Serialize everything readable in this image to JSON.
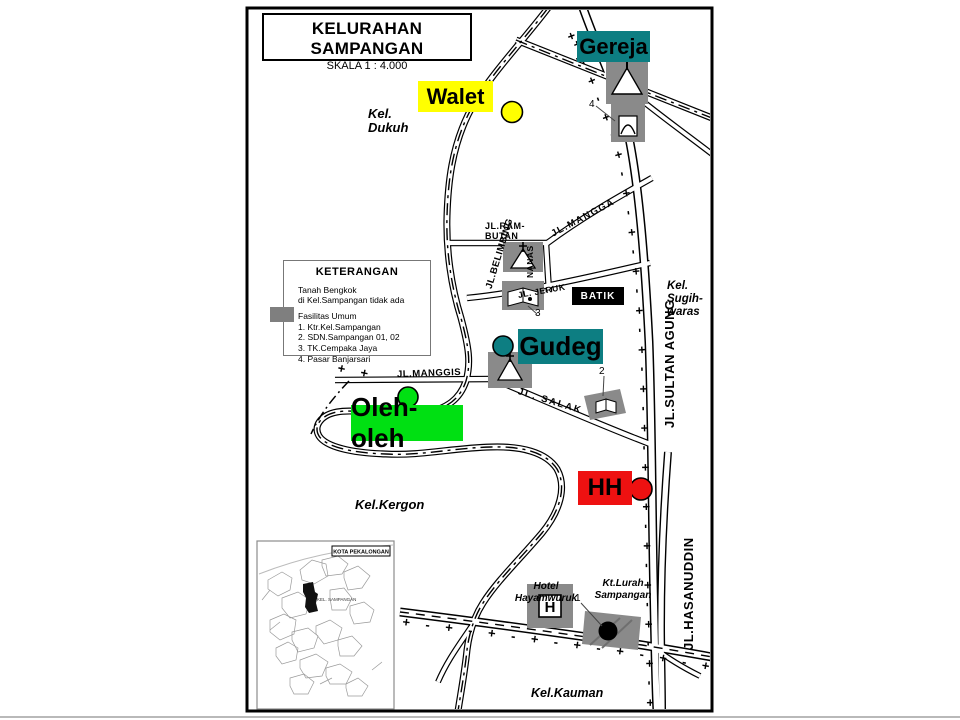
{
  "title_box": {
    "title": "KELURAHAN SAMPANGAN",
    "scale": "SKALA 1 : 4.000"
  },
  "legend": {
    "heading": "KETERANGAN",
    "note_line1": "Tanah Bengkok",
    "note_line2": "di Kel.Sampangan tidak ada",
    "facilities_heading": "Fasilitas Umum",
    "items": [
      {
        "label": "1. Ktr.Kel.Sampangan"
      },
      {
        "label": "2. SDN.Sampangan 01, 02"
      },
      {
        "label": "3. TK.Cempaka Jaya"
      },
      {
        "label": "4. Pasar Banjarsari"
      }
    ],
    "swatch_color": "#7f7f7f"
  },
  "markers": {
    "gereja": {
      "label": "Gereja",
      "bg": "#0d7e82"
    },
    "walet": {
      "label": "Walet",
      "bg": "#ffff00"
    },
    "gudeg": {
      "label": "Gudeg",
      "bg": "#0d7e82"
    },
    "oleh": {
      "label": "Oleh-oleh",
      "bg": "#00e012"
    },
    "hh": {
      "label": "HH",
      "bg": "#ee1111"
    }
  },
  "roads": {
    "belimbing": "JL.BELIMBING",
    "mangga": "JL.MANGGA",
    "rambutan_line1": "JL.RAM-",
    "rambutan_line2": "BUTAN",
    "nanas": "NANAS",
    "jeruk": "JL. JERUK",
    "manggis": "JL.MANGGIS",
    "salak": "JL. SALAK",
    "sultan_agung": "JL.SULTAN AGUNG",
    "hasanuddin": "JL.HASANUDDIN"
  },
  "areas": {
    "dukuh_line1": "Kel.",
    "dukuh_line2": "Dukuh",
    "sugihwaras_line1": "Kel.",
    "sugihwaras_line2": "Sugih-",
    "sugihwaras_line3": "waras",
    "kergon": "Kel.Kergon",
    "kauman": "Kel.Kauman"
  },
  "landmarks": {
    "batik": "BATIK",
    "hotel_line1": "Hotel",
    "hotel_line2": "Hayamwuruk",
    "hotel_letter": "H",
    "ktlurah_line1": "Kt.Lurah",
    "ktlurah_line2": "Sampangan"
  },
  "building_numbers": {
    "pasar": "4",
    "tk": "3",
    "sdn": "2",
    "ktr": "1"
  },
  "inset": {
    "title": "KOTA PEKALONGAN",
    "highlight_label": "KEL. SAMPANGAN"
  },
  "symbology": {
    "cross_dash": "+ -",
    "cross": "+"
  }
}
